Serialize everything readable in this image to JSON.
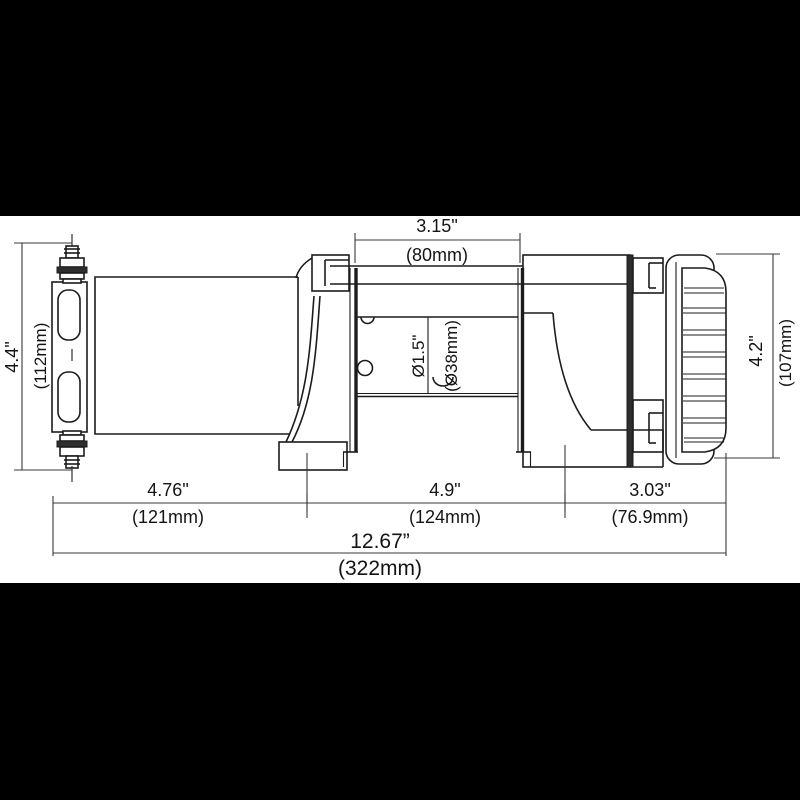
{
  "canvas": {
    "letterbox_color": "#000000",
    "paper_color": "#ffffff",
    "line_color": "#1c1c1c"
  },
  "drawing": {
    "subject": "electric winch side view dimensional drawing",
    "dimensions": {
      "drum_width": {
        "inches": "3.15\"",
        "metric": "(80mm)"
      },
      "fairlead_height": {
        "inches": "4.4\"",
        "metric": "(112mm)"
      },
      "drum_diameter": {
        "inches": "Ø1.5\"",
        "metric": "(Ø38mm)"
      },
      "motor_end_height": {
        "inches": "4.2\"",
        "metric": "(107mm)"
      },
      "motor_section_length": {
        "inches": "4.76\"",
        "metric": "(121mm)"
      },
      "drum_section_length": {
        "inches": "4.9\"",
        "metric": "(124mm)"
      },
      "gearbox_section_length": {
        "inches": "3.03\"",
        "metric": "(76.9mm)"
      },
      "overall_length": {
        "inches": "12.67”",
        "metric": "(322mm)"
      }
    }
  }
}
